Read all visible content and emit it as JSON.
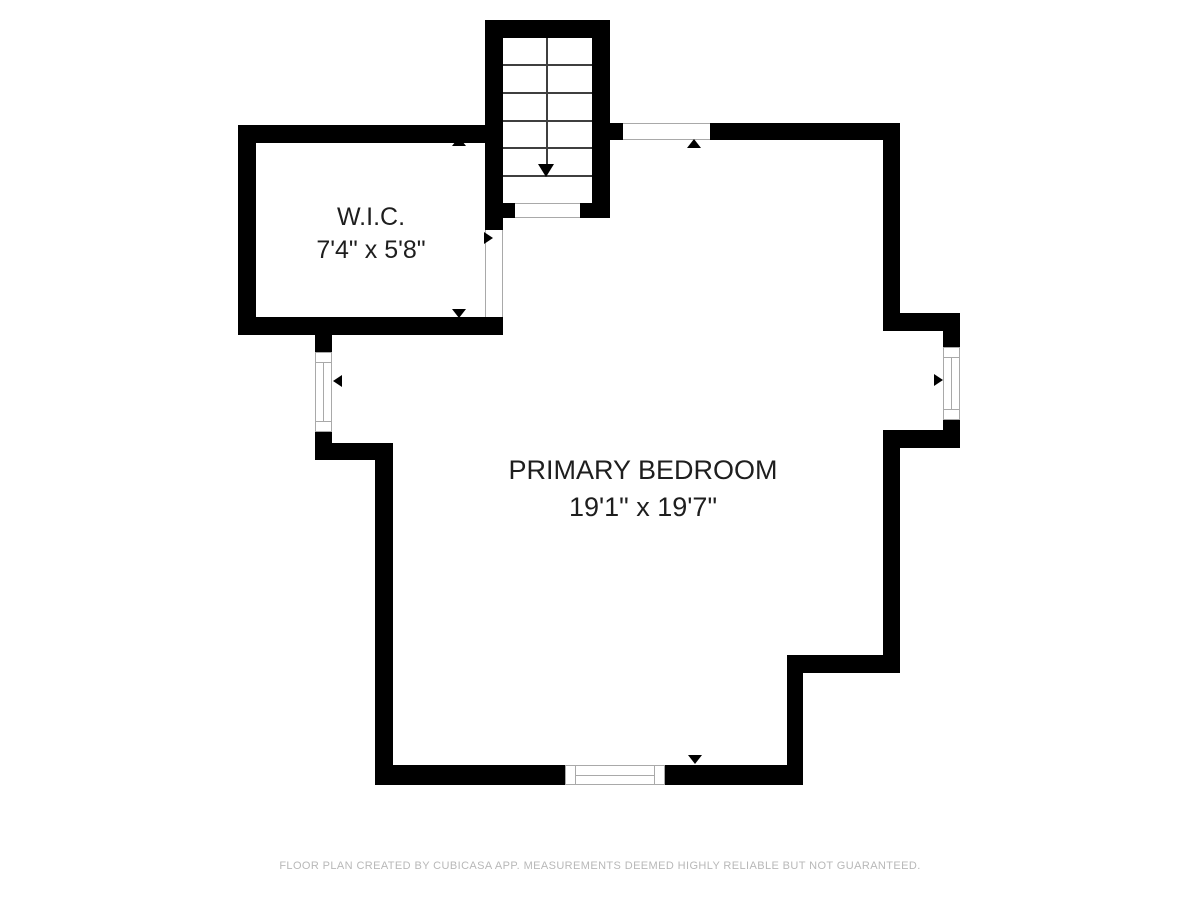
{
  "colors": {
    "wall": "#000000",
    "outline": "#a9a9a9",
    "tread": "#3f3f3f",
    "label": "#1e1e1e",
    "footer": "#b8b8b8",
    "background": "#ffffff"
  },
  "rooms": {
    "wic": {
      "label": "W.I.C.",
      "dimensions": "7'4\" x 5'8\""
    },
    "bedroom": {
      "label": "PRIMARY BEDROOM",
      "dimensions": "19'1\" x 19'7\""
    }
  },
  "stairs": {
    "direction": "down",
    "tread_count": 6
  },
  "footer": {
    "text": "FLOOR PLAN CREATED BY CUBICASA APP. MEASUREMENTS DEEMED HIGHLY RELIABLE BUT NOT GUARANTEED."
  }
}
